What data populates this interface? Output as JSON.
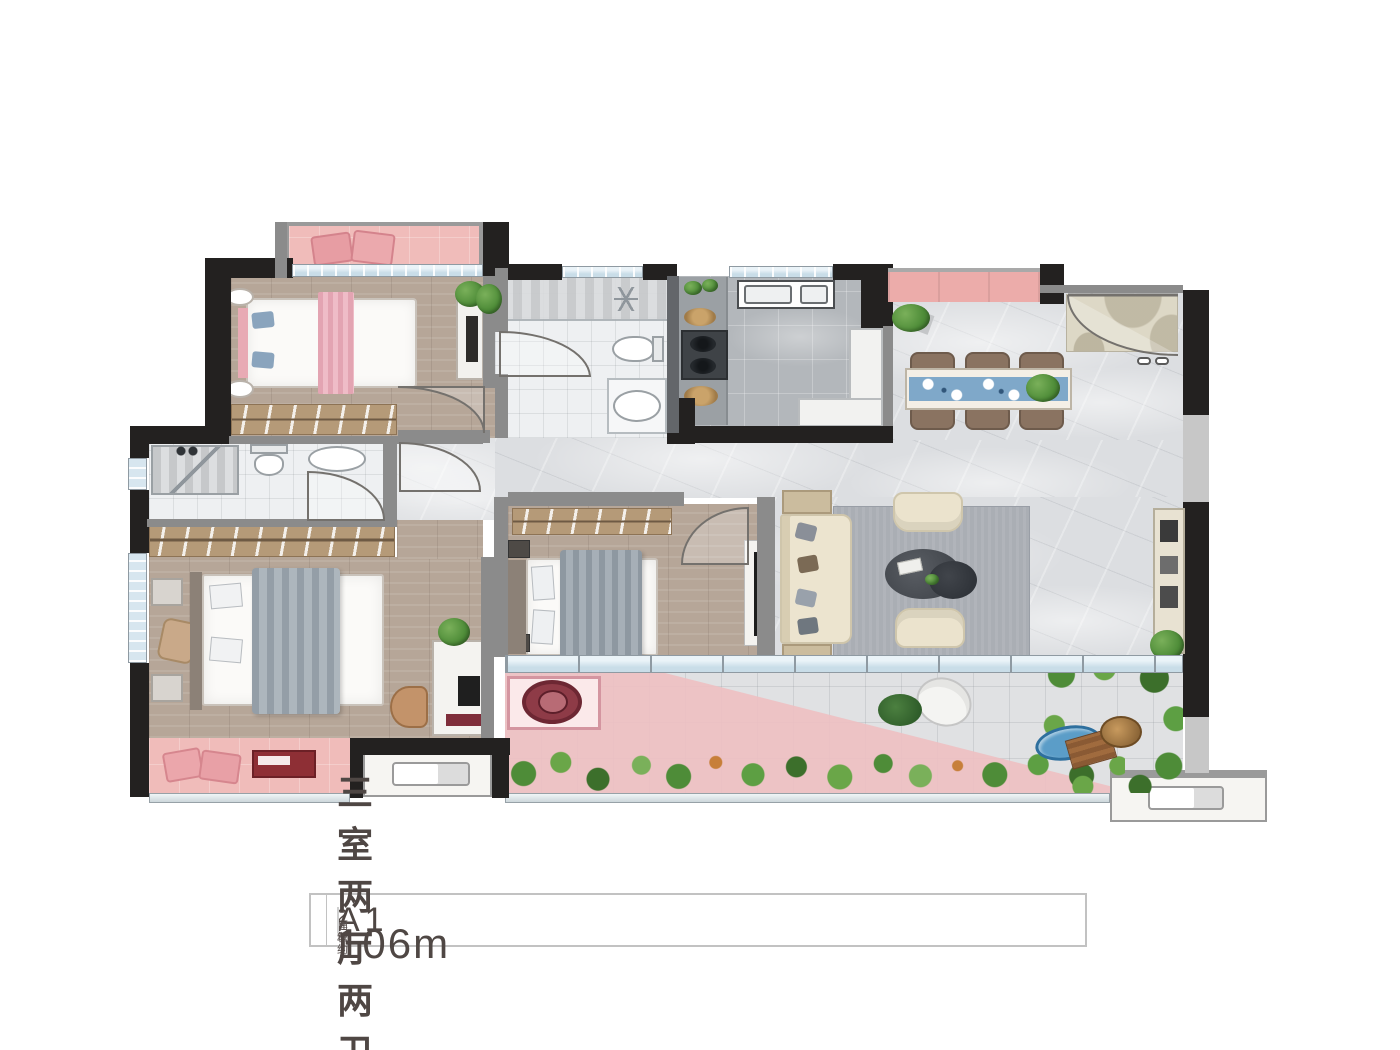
{
  "caption": {
    "unit_label": "A1",
    "divider": "",
    "area_label_line1": "建筑",
    "area_label_line2": "面积约",
    "area_value": "106m",
    "area_superscript": "2",
    "layout_label": "三室两厅两卫"
  },
  "plan": {
    "colors": {
      "wall_black": "#232120",
      "wall_gray": "#8b8b8b",
      "balcony_pink": "#f0bcba",
      "dining_table_blue": "#7fa8c9",
      "plant_green": "#4e8c38",
      "floor_wood": "#b6a698",
      "floor_marble": "#dcdee1",
      "rug_gray": "#aaaeb4",
      "sofa_cream": "#ece4cf",
      "washer_red": "#6d2733",
      "pond_blue": "#5b9dc8"
    }
  }
}
